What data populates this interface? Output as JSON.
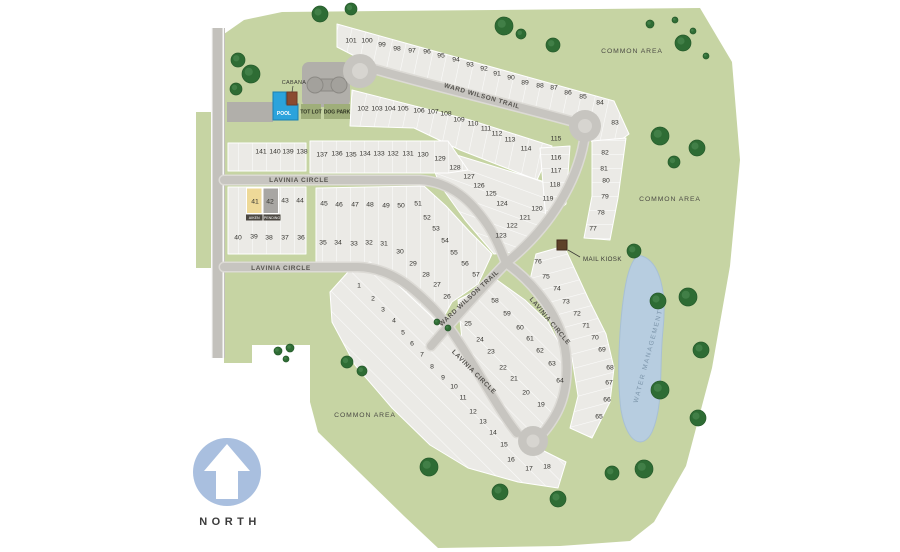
{
  "community_map": {
    "streets": {
      "ward_wilson_trail": "WARD WILSON TRAIL",
      "lavinia_circle": "LAVINIA CIRCLE"
    },
    "areas": {
      "common_area": "COMMON AREA",
      "water_management": "WATER MANAGEMENT"
    },
    "poi": {
      "mail_kiosk": "MAIL KIOSK",
      "cabana": "CABANA",
      "pool": "POOL",
      "tot_lot": "TOT LOT",
      "dog_park": "DOG PARK"
    },
    "compass": {
      "north": "NORTH"
    },
    "featured_lots": [
      {
        "lot": "41",
        "tag": "AIKEN",
        "fill": "#eed998"
      },
      {
        "lot": "42",
        "tag": "PENDING",
        "fill": "#a8a6a3"
      }
    ],
    "colors": {
      "common_green": "#c6d4a3",
      "parcel": "#ebeae6",
      "road": "#c7c5c0",
      "water": "#b7cde0",
      "tree": "#2e6c34",
      "pool_blue": "#2ba3dc",
      "north_badge": "#a9bfdf"
    },
    "lots": [
      [
        1,
        359,
        285
      ],
      [
        2,
        373,
        298
      ],
      [
        3,
        383,
        309
      ],
      [
        4,
        394,
        320
      ],
      [
        5,
        403,
        332
      ],
      [
        6,
        412,
        343
      ],
      [
        7,
        422,
        354
      ],
      [
        8,
        432,
        366
      ],
      [
        9,
        443,
        377
      ],
      [
        10,
        454,
        386
      ],
      [
        11,
        463,
        397
      ],
      [
        12,
        473,
        411
      ],
      [
        13,
        483,
        421
      ],
      [
        14,
        493,
        432
      ],
      [
        15,
        504,
        444
      ],
      [
        16,
        511,
        459
      ],
      [
        17,
        529,
        468
      ],
      [
        18,
        547,
        466
      ],
      [
        19,
        541,
        404
      ],
      [
        20,
        526,
        392
      ],
      [
        21,
        514,
        378
      ],
      [
        22,
        503,
        367
      ],
      [
        23,
        491,
        351
      ],
      [
        24,
        480,
        339
      ],
      [
        25,
        468,
        323
      ],
      [
        26,
        447,
        296
      ],
      [
        27,
        437,
        284
      ],
      [
        28,
        426,
        274
      ],
      [
        29,
        413,
        263
      ],
      [
        30,
        400,
        251
      ],
      [
        31,
        384,
        243
      ],
      [
        32,
        369,
        242
      ],
      [
        33,
        354,
        243
      ],
      [
        34,
        338,
        242
      ],
      [
        35,
        323,
        242
      ],
      [
        36,
        301,
        237
      ],
      [
        37,
        285,
        237
      ],
      [
        38,
        269,
        237
      ],
      [
        39,
        254,
        236
      ],
      [
        40,
        238,
        237
      ],
      [
        41,
        255,
        201
      ],
      [
        42,
        270,
        201
      ],
      [
        43,
        285,
        200
      ],
      [
        44,
        300,
        200
      ],
      [
        45,
        324,
        203
      ],
      [
        46,
        339,
        204
      ],
      [
        47,
        355,
        204
      ],
      [
        48,
        370,
        204
      ],
      [
        49,
        386,
        205
      ],
      [
        50,
        401,
        205
      ],
      [
        51,
        418,
        203
      ],
      [
        52,
        427,
        217
      ],
      [
        53,
        436,
        228
      ],
      [
        54,
        445,
        240
      ],
      [
        55,
        454,
        252
      ],
      [
        56,
        465,
        263
      ],
      [
        57,
        476,
        274
      ],
      [
        58,
        495,
        300
      ],
      [
        59,
        507,
        313
      ],
      [
        60,
        520,
        327
      ],
      [
        61,
        530,
        338
      ],
      [
        62,
        540,
        350
      ],
      [
        63,
        552,
        363
      ],
      [
        64,
        560,
        380
      ],
      [
        65,
        599,
        416
      ],
      [
        66,
        607,
        399
      ],
      [
        67,
        609,
        382
      ],
      [
        68,
        610,
        367
      ],
      [
        69,
        602,
        349
      ],
      [
        70,
        595,
        337
      ],
      [
        71,
        586,
        325
      ],
      [
        72,
        577,
        313
      ],
      [
        73,
        566,
        301
      ],
      [
        74,
        557,
        288
      ],
      [
        75,
        546,
        276
      ],
      [
        76,
        538,
        261
      ],
      [
        77,
        593,
        228
      ],
      [
        78,
        601,
        212
      ],
      [
        79,
        605,
        196
      ],
      [
        80,
        606,
        180
      ],
      [
        81,
        604,
        168
      ],
      [
        82,
        605,
        152
      ],
      [
        83,
        615,
        122
      ],
      [
        84,
        600,
        102
      ],
      [
        85,
        583,
        96
      ],
      [
        86,
        568,
        92
      ],
      [
        87,
        554,
        87
      ],
      [
        88,
        540,
        85
      ],
      [
        89,
        525,
        82
      ],
      [
        90,
        511,
        77
      ],
      [
        91,
        497,
        73
      ],
      [
        92,
        484,
        68
      ],
      [
        93,
        470,
        64
      ],
      [
        94,
        456,
        59
      ],
      [
        95,
        441,
        55
      ],
      [
        96,
        427,
        51
      ],
      [
        97,
        412,
        50
      ],
      [
        98,
        397,
        48
      ],
      [
        99,
        382,
        44
      ],
      [
        100,
        367,
        40
      ],
      [
        101,
        351,
        40
      ],
      [
        102,
        363,
        108
      ],
      [
        103,
        377,
        108
      ],
      [
        104,
        390,
        108
      ],
      [
        105,
        403,
        108
      ],
      [
        106,
        419,
        110
      ],
      [
        107,
        433,
        111
      ],
      [
        108,
        446,
        113
      ],
      [
        109,
        459,
        119
      ],
      [
        110,
        473,
        123
      ],
      [
        111,
        486,
        128
      ],
      [
        112,
        497,
        133
      ],
      [
        113,
        510,
        139
      ],
      [
        114,
        526,
        148
      ],
      [
        115,
        556,
        138
      ],
      [
        116,
        556,
        157
      ],
      [
        117,
        556,
        170
      ],
      [
        118,
        555,
        184
      ],
      [
        119,
        548,
        198
      ],
      [
        120,
        537,
        208
      ],
      [
        121,
        525,
        217
      ],
      [
        122,
        512,
        225
      ],
      [
        123,
        501,
        235
      ],
      [
        124,
        502,
        203
      ],
      [
        125,
        491,
        193
      ],
      [
        126,
        479,
        185
      ],
      [
        127,
        469,
        176
      ],
      [
        128,
        455,
        167
      ],
      [
        129,
        440,
        158
      ],
      [
        130,
        423,
        154
      ],
      [
        131,
        408,
        153
      ],
      [
        132,
        393,
        153
      ],
      [
        133,
        379,
        153
      ],
      [
        134,
        365,
        153
      ],
      [
        135,
        351,
        154
      ],
      [
        136,
        337,
        153
      ],
      [
        137,
        322,
        154
      ],
      [
        138,
        302,
        151
      ],
      [
        139,
        288,
        151
      ],
      [
        140,
        275,
        151
      ],
      [
        141,
        261,
        151
      ]
    ]
  }
}
